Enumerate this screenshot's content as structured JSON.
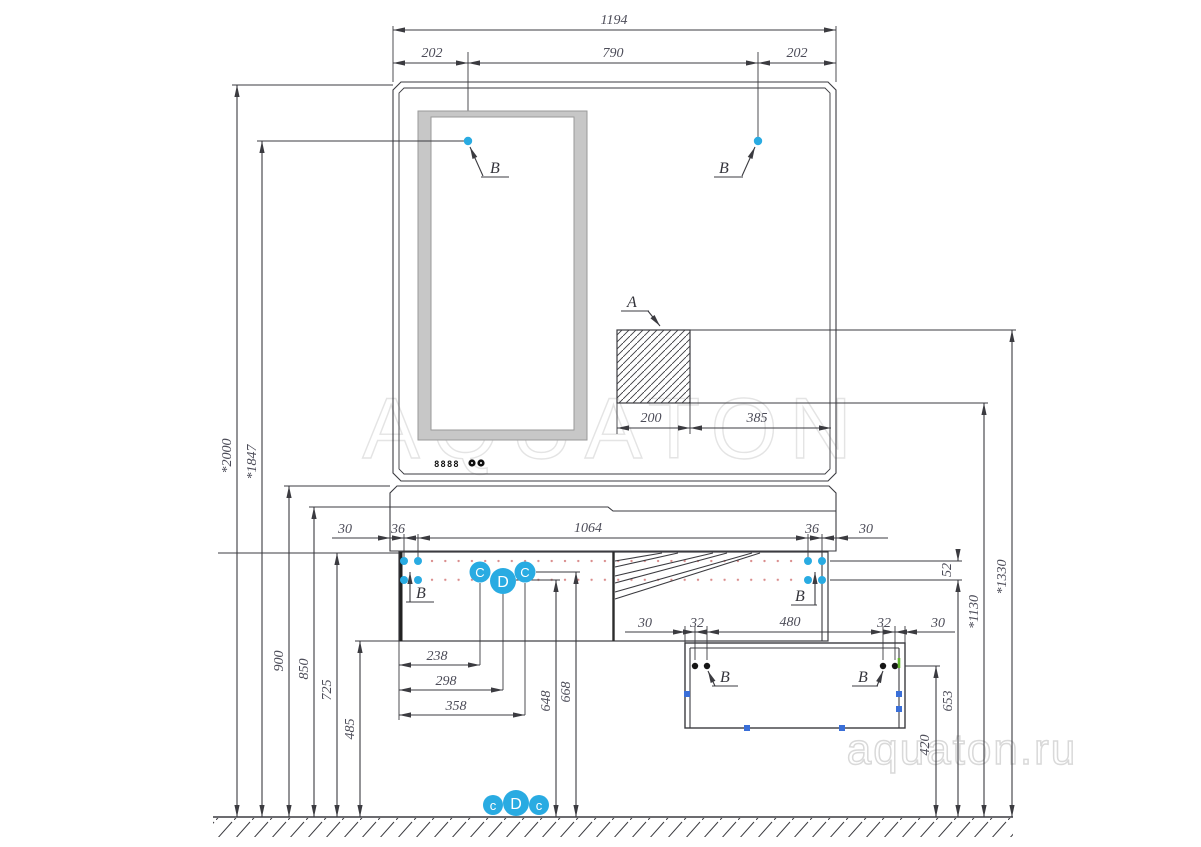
{
  "watermark": {
    "brand": "AQUATON",
    "site": "aquaton.ru"
  },
  "colors": {
    "accent": "#29abe2",
    "line": "#3b3b40",
    "red_dot": "#d98b8b",
    "green_tick": "#62b52d",
    "frame_gray": "#c7c7c7",
    "watermark": "#e2e2e2"
  },
  "mirror": {
    "display": "8888"
  },
  "labels": {
    "detail_a": "A",
    "detail_b": "B",
    "bubbles_top": [
      "C",
      "D",
      "C"
    ],
    "bubbles_bottom": [
      "c",
      "D",
      "c"
    ]
  },
  "dims": {
    "top_total": "1194",
    "top_left": "202",
    "top_center": "790",
    "top_right": "202",
    "mixer_width": "200",
    "mixer_offset": "385",
    "cab_30_left": "30",
    "cab_36_left": "36",
    "cab_span": "1064",
    "cab_36_right": "36",
    "cab_30_right": "30",
    "low_30_left": "30",
    "low_32_left": "32",
    "low_span": "480",
    "low_32_right": "32",
    "low_30_right": "30",
    "h_2000": "*2000",
    "h_1847": "*1847",
    "h_900": "900",
    "h_850": "850",
    "h_725": "725",
    "h_485": "485",
    "h_1330": "*1330",
    "h_1130": "*1130",
    "h_52": "52",
    "h_653": "653",
    "h_420": "420",
    "w_238": "238",
    "w_298": "298",
    "w_358": "358",
    "h_648": "648",
    "h_668": "668"
  }
}
